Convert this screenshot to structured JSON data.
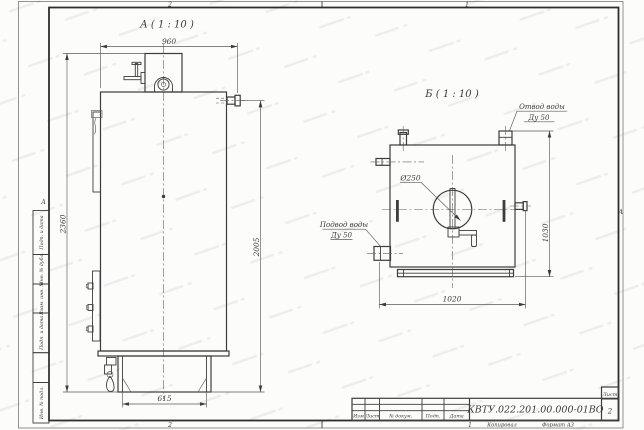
{
  "sheet": {
    "zones": {
      "top_left": "2",
      "top_right": "1",
      "bottom_left": "2",
      "bottom_right": "1",
      "left_letter": "А",
      "right_letter": "А"
    },
    "margin_labels": [
      "Подп. и дата",
      "Инв. № дубл.",
      "Взам. инв. №",
      "Подп. и дата",
      "Инв. № подл."
    ],
    "footer": {
      "copied": "Копировал",
      "format": "Формат А3"
    }
  },
  "title_block": {
    "doc_number": "КВТУ.022.201.00.000-01ВО",
    "sheet_label": "Лист",
    "sheet_number": "2",
    "columns": [
      "Изм",
      "Лист",
      "№ докум.",
      "Подп.",
      "Дата"
    ]
  },
  "view_a": {
    "label": "А ( 1 : 10 )",
    "dim_width_top": "960",
    "dim_height_overall": "2360",
    "dim_height_outlet": "2005",
    "dim_base_width": "615"
  },
  "view_b": {
    "label": "Б ( 1 : 10 )",
    "dim_width": "1020",
    "dim_height": "1030",
    "dim_flue": "Ø250",
    "outlet_callout": [
      "Отвод воды",
      "Ду 50"
    ],
    "inlet_callout": [
      "Подвод воды",
      "Ду 50"
    ]
  }
}
